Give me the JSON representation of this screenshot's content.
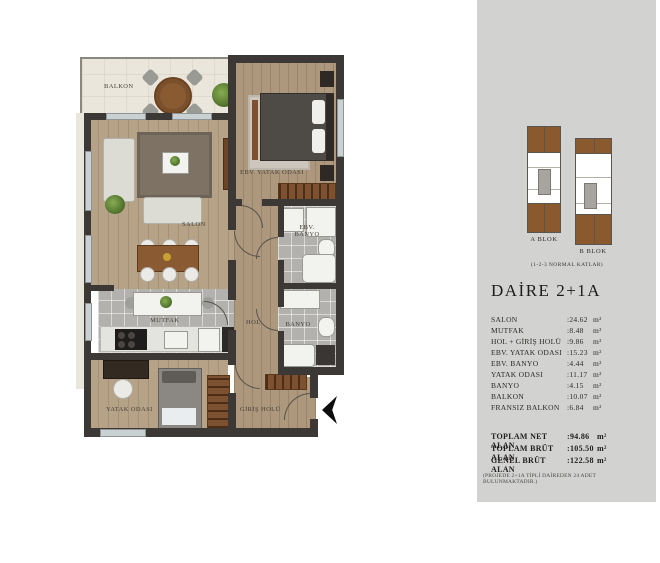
{
  "plan": {
    "labels": {
      "balkon": "BALKON",
      "salon": "SALON",
      "ebv_yatak": "EBV. YATAK ODASI",
      "ebv_banyo_1": "EBV.",
      "ebv_banyo_2": "BANYO",
      "mutfak": "MUTFAK",
      "hol": "HOL",
      "banyo": "BANYO",
      "yatak": "YATAK ODASI",
      "giris": "GİRİŞ HOLÜ"
    }
  },
  "panel": {
    "blocks": [
      {
        "label": "A BLOK"
      },
      {
        "label": "B BLOK"
      }
    ],
    "floors_note": "(1-2-3 NORMAL KATLAR)",
    "title": "DAİRE 2+1A",
    "rooms": [
      {
        "name": "SALON",
        "value": ":24.62",
        "unit": "m²"
      },
      {
        "name": "MUTFAK",
        "value": ":8.48",
        "unit": "m²"
      },
      {
        "name": "HOL + GİRİŞ HOLÜ",
        "value": ":9.86",
        "unit": "m²"
      },
      {
        "name": "EBV. YATAK ODASI",
        "value": ":15.23",
        "unit": "m²"
      },
      {
        "name": "EBV. BANYO",
        "value": ":4.44",
        "unit": "m²"
      },
      {
        "name": "YATAK ODASI",
        "value": ":11.17",
        "unit": "m²"
      },
      {
        "name": "BANYO",
        "value": ":4.15",
        "unit": "m²"
      },
      {
        "name": "BALKON",
        "value": ":10.07",
        "unit": "m²"
      },
      {
        "name": "FRANSIZ BALKON",
        "value": ":6.84",
        "unit": "m²"
      }
    ],
    "totals": [
      {
        "name": "TOPLAM NET ALAN",
        "value": ":94.86",
        "unit": "m²"
      },
      {
        "name": "TOPLAM BRÜT ALAN",
        "value": ":105.50",
        "unit": "m²"
      },
      {
        "name": "GENEL BRÜT ALAN",
        "value": ":122.58",
        "unit": "m²"
      }
    ],
    "footnote": "(PROJEDE 2+1A TİPLİ DAİREDEN 24 ADET BULUNMAKTADIR.)"
  },
  "colors": {
    "panel_bg": "#d2d2d0",
    "wall": "#3b3835",
    "block_brown": "#8a5a2e",
    "wood_floor": "#b6a287",
    "tile_floor": "#b2b1ae",
    "balcony_floor": "#eae6db",
    "entry_arrow": "#0d0d0d"
  }
}
